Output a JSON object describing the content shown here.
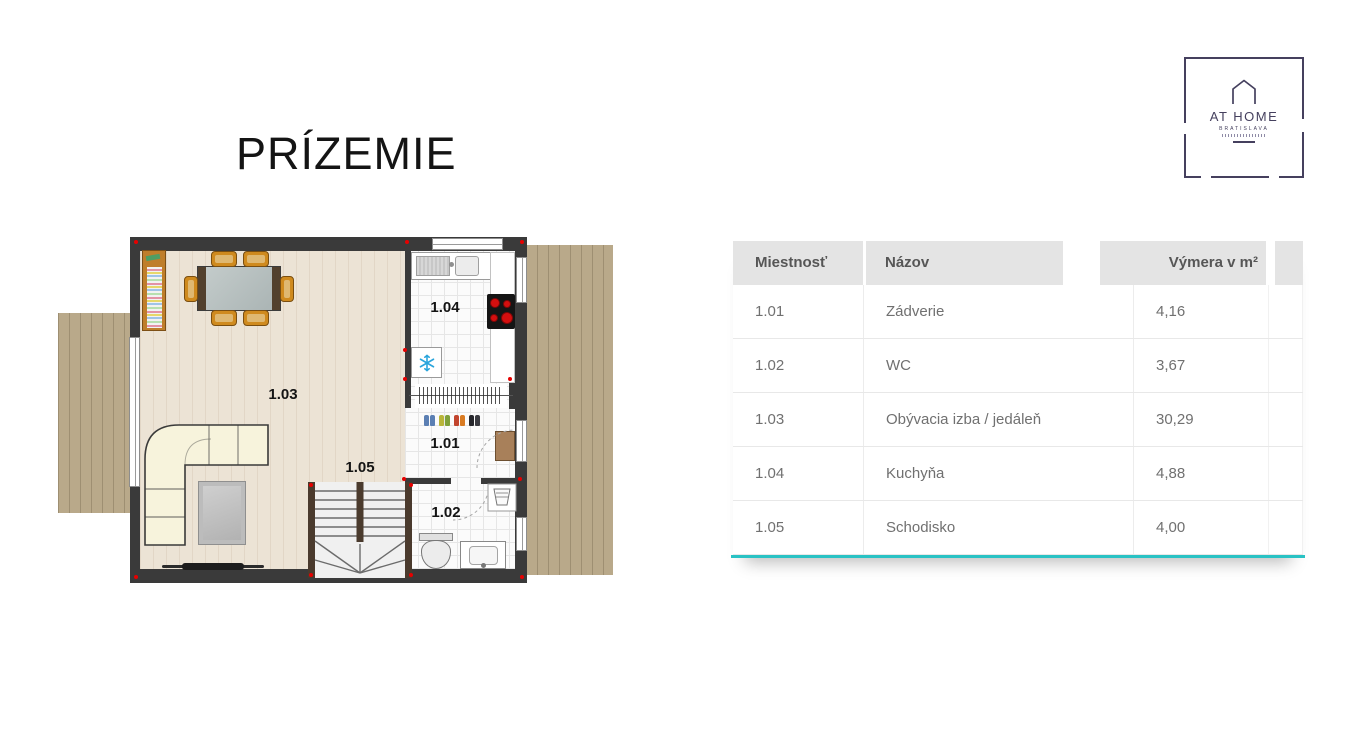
{
  "page": {
    "title": "PRÍZEMIE"
  },
  "logo": {
    "title": "AT HOME",
    "subtitle": "BRATISLAVA",
    "color": "#45405e"
  },
  "floorplan": {
    "labels": {
      "hall": "1.01",
      "wc": "1.02",
      "living": "1.03",
      "kitchen": "1.04",
      "stairs": "1.05"
    }
  },
  "table": {
    "columns": [
      "Miestnosť",
      "Názov",
      "Výmera v m²"
    ],
    "rows": [
      {
        "id": "1.01",
        "name": "Zádverie",
        "area": "4,16"
      },
      {
        "id": "1.02",
        "name": "WC",
        "area": "3,67"
      },
      {
        "id": "1.03",
        "name": "Obývacia izba / jedáleň",
        "area": "30,29"
      },
      {
        "id": "1.04",
        "name": "Kuchyňa",
        "area": "4,88"
      },
      {
        "id": "1.05",
        "name": "Schodisko",
        "area": "4,00"
      }
    ],
    "accent_color": "#29c2c4"
  }
}
